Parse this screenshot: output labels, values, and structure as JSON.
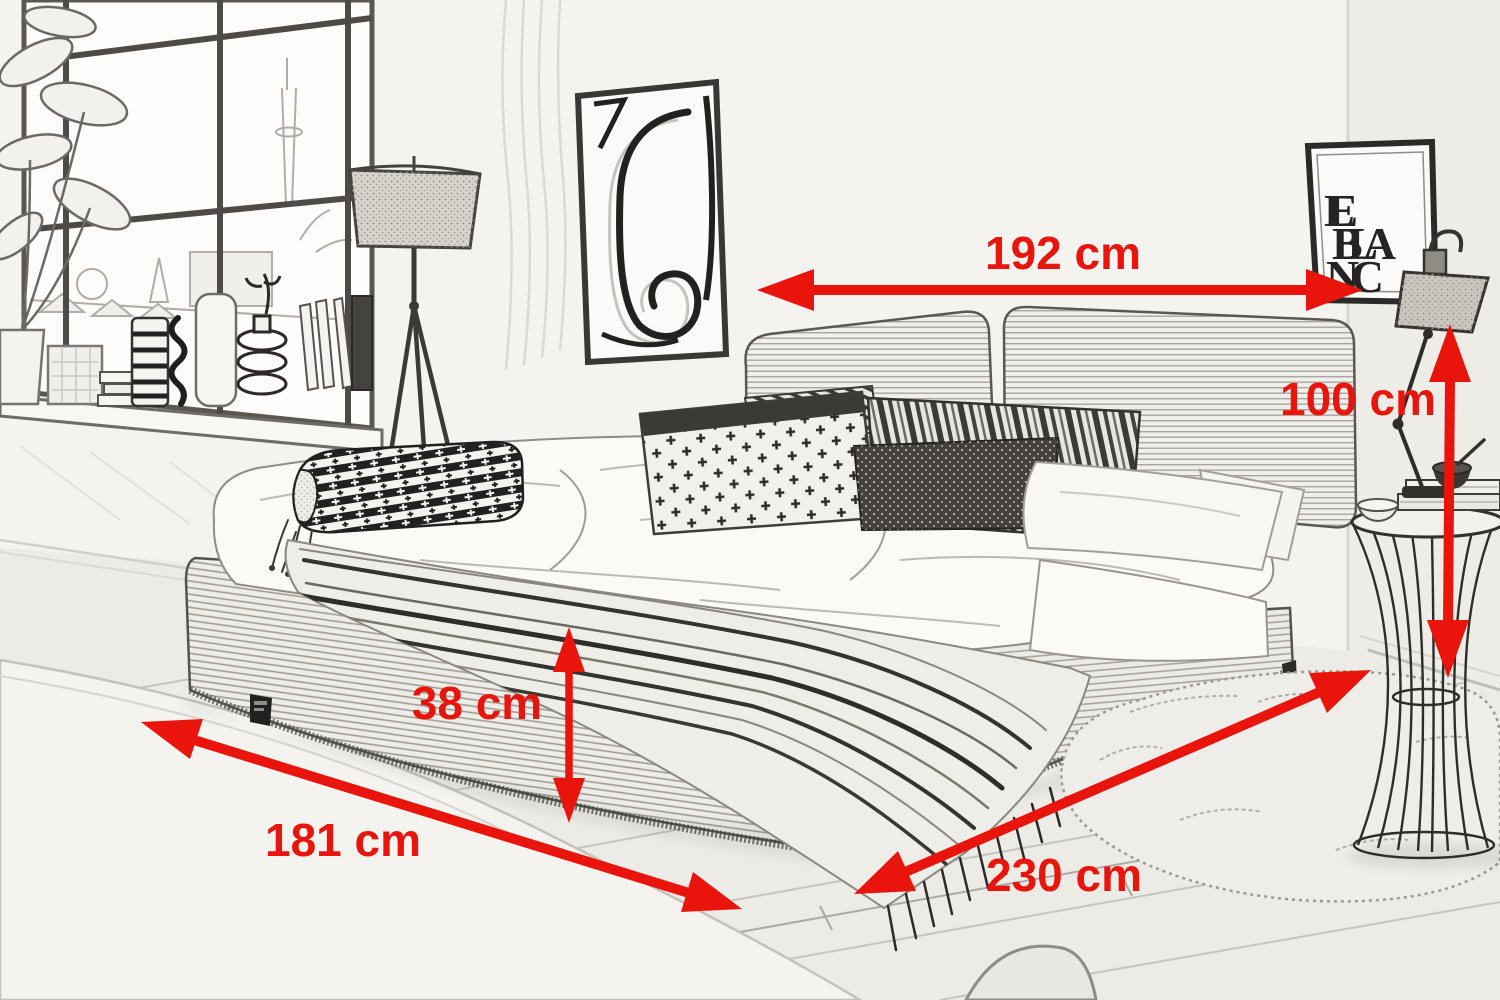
{
  "accent_color": "#e9140b",
  "sketch_line_color": "#55524c",
  "paper_color": "#f4f3f0",
  "dimension_labels": {
    "bed_width": "192 cm",
    "headboard_height": "100 cm",
    "frame_height": "38 cm",
    "front_width": "181 cm",
    "side_length": "230 cm"
  },
  "leblanc_poster": {
    "lines": [
      "LE",
      "BLA",
      "NC"
    ]
  }
}
